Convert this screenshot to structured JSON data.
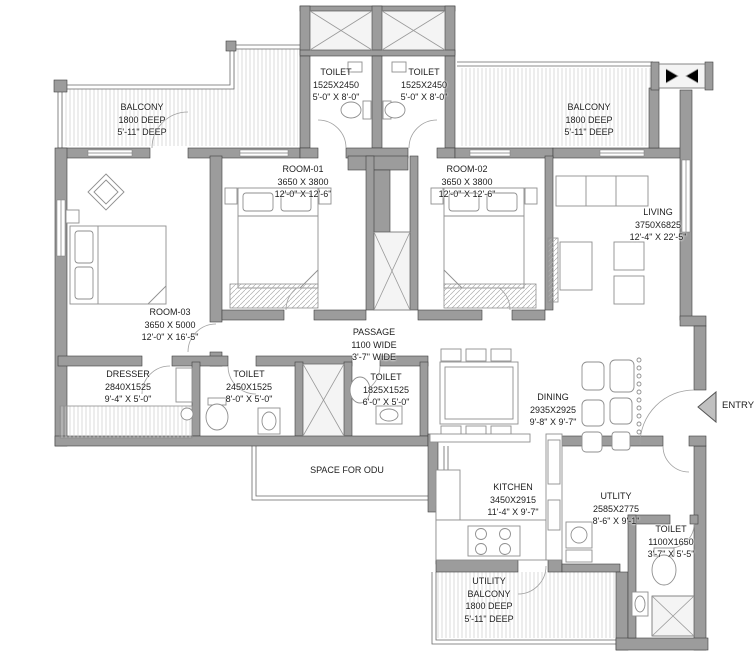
{
  "colors": {
    "wall": "#9c9c9c",
    "thin_line": "#6a6a6a",
    "hatch": "#cfcfcf",
    "text": "#1d1d1d",
    "entry_arrow": "#c0c0c0"
  },
  "labels": {
    "toilet_top_left": {
      "line1": "TOILET",
      "line2": "1525X2450",
      "line3": "5'-0\" X 8'-0\""
    },
    "toilet_top_right": {
      "line1": "TOILET",
      "line2": "1525X2450",
      "line3": "5'-0\" X 8'-0\""
    },
    "balcony_left": {
      "line1": "BALCONY",
      "line2": "1800 DEEP",
      "line3": "5'-11\" DEEP"
    },
    "balcony_right": {
      "line1": "BALCONY",
      "line2": "1800 DEEP",
      "line3": "5'-11\" DEEP"
    },
    "room_01": {
      "line1": "ROOM-01",
      "line2": "3650 X 3800",
      "line3": "12'-0\" X 12'-6\""
    },
    "room_02": {
      "line1": "ROOM-02",
      "line2": "3650 X 3800",
      "line3": "12'-0\" X 12'-6\""
    },
    "living": {
      "line1": "LIVING",
      "line2": "3750X6825",
      "line3": "12'-4\" X 22'-5\""
    },
    "room_03": {
      "line1": "ROOM-03",
      "line2": "3650 X 5000",
      "line3": "12'-0\" X 16'-5\""
    },
    "passage": {
      "line1": "PASSAGE",
      "line2": "1100 WIDE",
      "line3": "3'-7\" WIDE"
    },
    "dresser": {
      "line1": "DRESSER",
      "line2": "2840X1525",
      "line3": "9'-4\" X 5'-0\""
    },
    "toilet_mid_left": {
      "line1": "TOILET",
      "line2": "2450X1525",
      "line3": "8'-0\" X 5'-0\""
    },
    "toilet_mid_right": {
      "line1": "TOILET",
      "line2": "1825X1525",
      "line3": "6'-0\" X 5'-0\""
    },
    "dining": {
      "line1": "DINING",
      "line2": "2935X2925",
      "line3": "9'-8\" X 9'-7\""
    },
    "kitchen": {
      "line1": "KITCHEN",
      "line2": "3450X2915",
      "line3": "11'-4\" X 9'-7\""
    },
    "utility": {
      "line1": "UTLITY",
      "line2": "2585X2775",
      "line3": "8'-6\" X 9'-1\""
    },
    "toilet_bottom_right": {
      "line1": "TOILET",
      "line2": "1100X1650",
      "line3": "3'-7\" X 5'-5\""
    },
    "utility_balcony": {
      "line1": "UTILITY",
      "line2": "BALCONY",
      "line3": "1800 DEEP",
      "line4": "5'-11\" DEEP"
    },
    "odu": {
      "line1": "SPACE FOR ODU"
    },
    "entry": {
      "line1": "ENTRY"
    }
  }
}
